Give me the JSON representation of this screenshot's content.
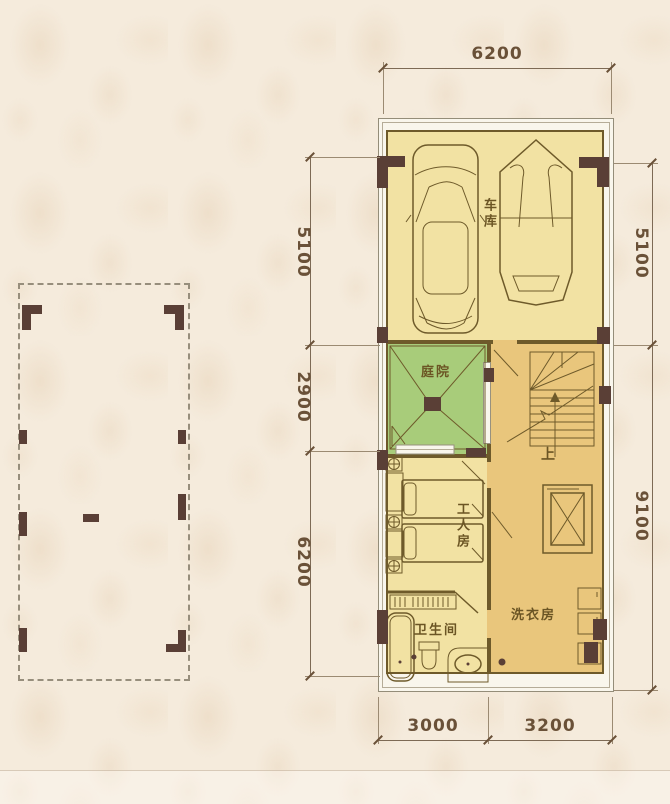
{
  "plan": {
    "rooms": {
      "garage": "车库",
      "courtyard": "庭院",
      "workers_room": "工人房",
      "bathroom": "卫生间",
      "laundry": "洗衣房",
      "stairs_up": "上"
    },
    "dimensions": {
      "top": "6200",
      "left_upper": "5100",
      "left_middle": "2900",
      "left_lower": "6200",
      "right_upper": "5100",
      "right_lower": "9100",
      "bottom_left": "3000",
      "bottom_right": "3200"
    },
    "colors": {
      "wallpaper": "#f5ebdc",
      "room_pale_yellow": "#f2e2a3",
      "courtyard_green": "#a8cc7a",
      "hall_tan": "#e9c67c",
      "wall_olive": "#6e5a2a",
      "column_brown": "#5a3f36",
      "dimension_text": "#6a5138"
    }
  }
}
